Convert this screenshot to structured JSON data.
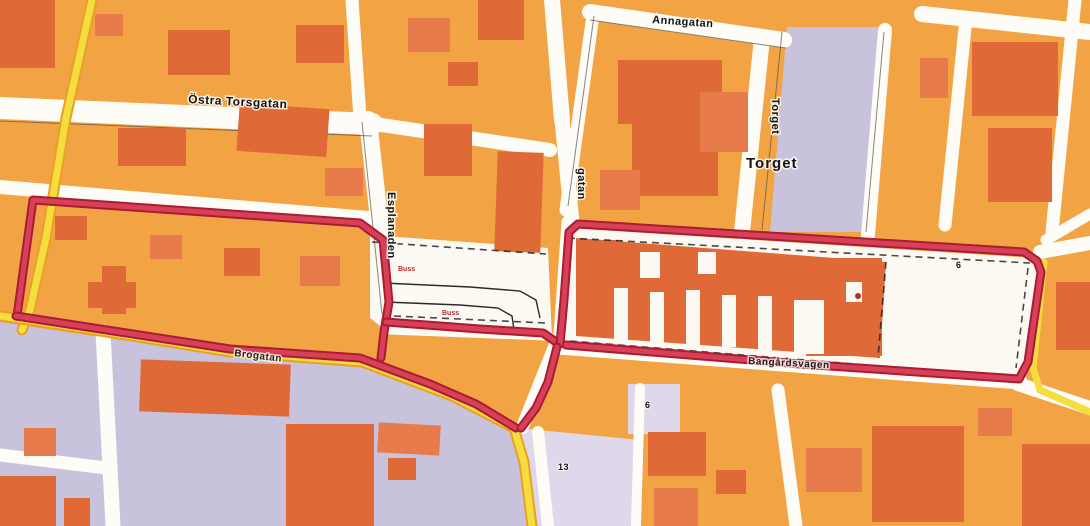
{
  "map": {
    "title": "Scanned town street map with red route outline",
    "labels": {
      "ostra_torsgatan": "Östra Torsgatan",
      "annagatan": "Annagatan",
      "torget_street": "Torget",
      "torget_square": "Torget",
      "esplanaden": "Esplanaden",
      "gatan_partial": "gatan",
      "bangardsvagen": "Bangårdsvägen",
      "brogatan": "Brogatan",
      "bus_stop_a": "Buss",
      "bus_stop_b": "Buss",
      "lot_number_west": "6",
      "lot_number_east": "6",
      "lot_number_south": "13"
    },
    "colors": {
      "background_orange": "#f2a444",
      "building_orange": "#df6937",
      "building_orange_light": "#e77b4b",
      "lavender_block": "#c9c2dd",
      "street_white": "#fdfcf7",
      "road_yellow": "#f4dd3c",
      "road_yellow_casing": "#e8a126",
      "route_red": "#d84058",
      "route_red_dark": "#a81c34",
      "label_black": "#141414",
      "bus_label_red": "#c22222"
    }
  }
}
